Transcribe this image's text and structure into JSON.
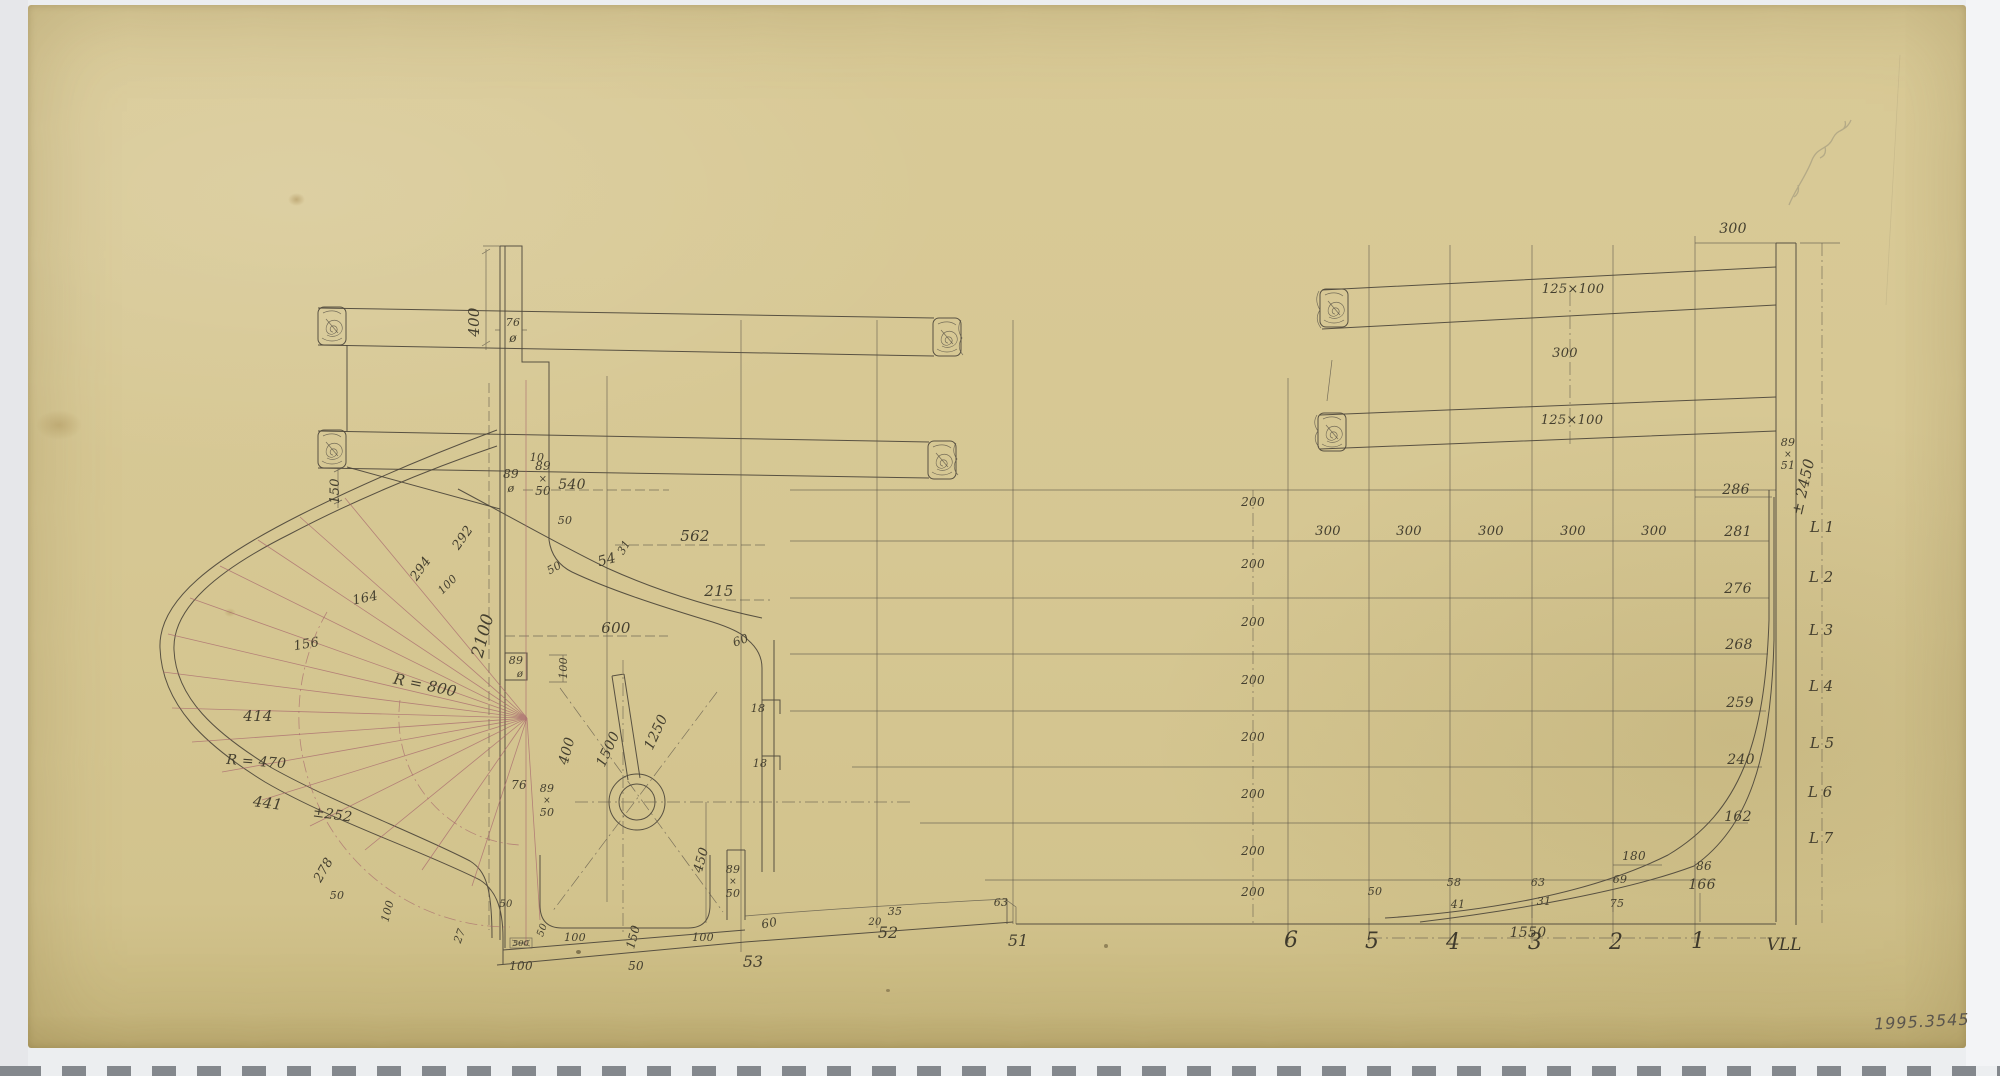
{
  "artifact": {
    "accession_number": "1995.3545",
    "pencil_note": "illegible pencil inscription (top right)"
  },
  "palette": {
    "paper": "#d6c793",
    "ink": "#4d463b",
    "red_construction_lines": "#a5636c",
    "film_strip_mark": "#84888d",
    "scan_background": "#eceef0"
  },
  "views": {
    "stern_detail": {
      "labels": [
        [
          "400",
          479,
          322,
          -90,
          15,
          "dim"
        ],
        [
          "76",
          513,
          326,
          0,
          11,
          "dim"
        ],
        [
          "ø",
          513,
          342,
          0,
          12,
          "dim"
        ],
        [
          "150",
          339,
          491,
          -90,
          13,
          "dim"
        ],
        [
          "10",
          537,
          461,
          0,
          11,
          "dim"
        ],
        [
          "89",
          511,
          478,
          0,
          12,
          "dim"
        ],
        [
          "ø",
          511,
          492,
          0,
          11,
          "dim"
        ],
        [
          "89",
          543,
          470,
          0,
          12,
          "dim"
        ],
        [
          "×",
          543,
          482,
          0,
          10,
          "dim"
        ],
        [
          "50",
          543,
          495,
          0,
          12,
          "dim"
        ],
        [
          "540",
          572,
          489,
          0,
          14,
          "dim"
        ],
        [
          "50",
          565,
          524,
          0,
          11,
          "dim"
        ],
        [
          "50",
          556,
          571,
          -30,
          11,
          "dim"
        ],
        [
          "562",
          695,
          541,
          0,
          15,
          "dim"
        ],
        [
          "54",
          608,
          564,
          -15,
          14,
          "dim"
        ],
        [
          "31",
          627,
          549,
          -60,
          11,
          "dim"
        ],
        [
          "215",
          719,
          596,
          0,
          15,
          "dim"
        ],
        [
          "600",
          616,
          633,
          0,
          15,
          "dim"
        ],
        [
          "60",
          742,
          644,
          -20,
          12,
          "dim"
        ],
        [
          "18",
          758,
          712,
          0,
          11,
          "dim"
        ],
        [
          "18",
          760,
          767,
          0,
          11,
          "dim"
        ],
        [
          "292",
          466,
          540,
          -55,
          13,
          "dim"
        ],
        [
          "294",
          424,
          571,
          -55,
          13,
          "dim"
        ],
        [
          "100",
          450,
          587,
          -45,
          11,
          "dim"
        ],
        [
          "164",
          366,
          602,
          -12,
          13,
          "dim"
        ],
        [
          "156",
          307,
          648,
          -10,
          13,
          "dim"
        ],
        [
          "R = 800",
          424,
          690,
          12,
          15,
          "dim"
        ],
        [
          "414",
          258,
          721,
          0,
          15,
          "dim"
        ],
        [
          "R = 470",
          256,
          766,
          4,
          14,
          "dim"
        ],
        [
          "441",
          267,
          808,
          8,
          15,
          "dim"
        ],
        [
          "±252",
          332,
          819,
          8,
          14,
          "dim"
        ],
        [
          "278",
          327,
          872,
          -60,
          13,
          "dim"
        ],
        [
          "50",
          337,
          899,
          0,
          11,
          "dim"
        ],
        [
          "100",
          391,
          912,
          -75,
          11,
          "dim"
        ],
        [
          "2100",
          488,
          637,
          -75,
          17,
          "dim"
        ],
        [
          "89",
          516,
          664,
          0,
          11,
          "dim"
        ],
        [
          "ø",
          520,
          677,
          0,
          10,
          "dim"
        ],
        [
          "100",
          567,
          668,
          -90,
          11,
          "dim"
        ],
        [
          "400",
          571,
          752,
          -75,
          14,
          "dim"
        ],
        [
          "1500",
          612,
          751,
          -65,
          14,
          "dim"
        ],
        [
          "1250",
          660,
          734,
          -65,
          14,
          "dim"
        ],
        [
          "76",
          519,
          789,
          0,
          12,
          "dim"
        ],
        [
          "89",
          547,
          792,
          0,
          11,
          "dim"
        ],
        [
          "×",
          547,
          803,
          0,
          9,
          "dim"
        ],
        [
          "50",
          547,
          816,
          0,
          11,
          "dim"
        ],
        [
          "27",
          463,
          937,
          -70,
          11,
          "dim"
        ],
        [
          "50",
          506,
          907,
          0,
          10,
          "dim"
        ],
        [
          "500",
          521,
          946,
          0,
          8,
          "dim"
        ],
        [
          "50",
          545,
          931,
          -70,
          10,
          "dim"
        ],
        [
          "100",
          575,
          941,
          0,
          11,
          "dim"
        ],
        [
          "150",
          637,
          938,
          -75,
          12,
          "dim"
        ],
        [
          "100",
          703,
          941,
          0,
          11,
          "dim"
        ],
        [
          "450",
          705,
          861,
          -75,
          13,
          "dim"
        ],
        [
          "89",
          733,
          873,
          0,
          11,
          "dim"
        ],
        [
          "×",
          733,
          884,
          0,
          9,
          "dim"
        ],
        [
          "50",
          733,
          897,
          0,
          11,
          "dim"
        ],
        [
          "60",
          770,
          927,
          -10,
          12,
          "dim"
        ],
        [
          "53",
          753,
          967,
          0,
          16,
          "sta2"
        ],
        [
          "50",
          636,
          970,
          0,
          12,
          "dim"
        ],
        [
          "100",
          521,
          970,
          0,
          12,
          "dim"
        ],
        [
          "35",
          895,
          915,
          0,
          11,
          "dim"
        ],
        [
          "20",
          875,
          925,
          0,
          10,
          "dim"
        ],
        [
          "52",
          888,
          938,
          0,
          16,
          "sta2"
        ],
        [
          "63",
          1001,
          906,
          0,
          11,
          "dim"
        ],
        [
          "51",
          1018,
          946,
          0,
          16,
          "sta2"
        ]
      ]
    },
    "bow_grid": {
      "labels": [
        [
          "200",
          1253,
          506,
          0,
          12,
          "dim"
        ],
        [
          "200",
          1253,
          568,
          0,
          12,
          "dim"
        ],
        [
          "200",
          1253,
          626,
          0,
          12,
          "dim"
        ],
        [
          "200",
          1253,
          684,
          0,
          12,
          "dim"
        ],
        [
          "200",
          1253,
          741,
          0,
          12,
          "dim"
        ],
        [
          "200",
          1253,
          798,
          0,
          12,
          "dim"
        ],
        [
          "200",
          1253,
          855,
          0,
          12,
          "dim"
        ],
        [
          "200",
          1253,
          896,
          0,
          12,
          "dim"
        ],
        [
          "300",
          1328,
          535,
          0,
          13,
          "dim"
        ],
        [
          "300",
          1409,
          535,
          0,
          13,
          "dim"
        ],
        [
          "300",
          1491,
          535,
          0,
          13,
          "dim"
        ],
        [
          "300",
          1573,
          535,
          0,
          13,
          "dim"
        ],
        [
          "300",
          1654,
          535,
          0,
          13,
          "dim"
        ],
        [
          "286",
          1736,
          494,
          0,
          14,
          "dim"
        ],
        [
          "281",
          1738,
          536,
          0,
          14,
          "dim"
        ],
        [
          "276",
          1738,
          593,
          0,
          14,
          "dim"
        ],
        [
          "268",
          1739,
          649,
          0,
          14,
          "dim"
        ],
        [
          "259",
          1740,
          707,
          0,
          14,
          "dim"
        ],
        [
          "240",
          1741,
          764,
          0,
          14,
          "dim"
        ],
        [
          "162",
          1738,
          821,
          0,
          14,
          "dim"
        ],
        [
          "86",
          1704,
          870,
          0,
          12,
          "dim"
        ],
        [
          "180",
          1634,
          860,
          0,
          12,
          "dim"
        ],
        [
          "69",
          1620,
          883,
          0,
          11,
          "dim"
        ],
        [
          "75",
          1617,
          907,
          0,
          11,
          "dim"
        ],
        [
          "63",
          1538,
          886,
          0,
          11,
          "dim"
        ],
        [
          "31",
          1544,
          905,
          0,
          11,
          "dim"
        ],
        [
          "58",
          1454,
          886,
          0,
          11,
          "dim"
        ],
        [
          "41",
          1458,
          908,
          0,
          11,
          "dim"
        ],
        [
          "50",
          1375,
          895,
          0,
          11,
          "dim"
        ],
        [
          "166",
          1702,
          889,
          0,
          14,
          "dim"
        ],
        [
          "1550",
          1528,
          937,
          0,
          14,
          "dim"
        ],
        [
          "6",
          1291,
          947,
          0,
          22,
          "sta"
        ],
        [
          "5",
          1372,
          948,
          0,
          22,
          "sta"
        ],
        [
          "4",
          1453,
          949,
          0,
          22,
          "sta"
        ],
        [
          "3",
          1535,
          949,
          0,
          22,
          "sta"
        ],
        [
          "2",
          1616,
          949,
          0,
          22,
          "sta"
        ],
        [
          "1",
          1698,
          948,
          0,
          22,
          "sta"
        ],
        [
          "VLL",
          1784,
          950,
          0,
          17,
          "sta"
        ],
        [
          "125×100",
          1573,
          293,
          0,
          13,
          "dim"
        ],
        [
          "300",
          1565,
          357,
          0,
          13,
          "dim"
        ],
        [
          "125×100",
          1572,
          424,
          0,
          13,
          "dim"
        ],
        [
          "300",
          1733,
          233,
          0,
          14,
          "dim"
        ],
        [
          "89",
          1788,
          446,
          0,
          11,
          "dim"
        ],
        [
          "×",
          1788,
          457,
          0,
          9,
          "dim"
        ],
        [
          "51",
          1788,
          469,
          0,
          11,
          "dim"
        ],
        [
          "± 2450",
          1808,
          488,
          -77,
          15,
          "dim"
        ],
        [
          "L 1",
          1822,
          532,
          0,
          15,
          "sta2"
        ],
        [
          "L 2",
          1821,
          582,
          0,
          15,
          "sta2"
        ],
        [
          "L 3",
          1821,
          635,
          0,
          15,
          "sta2"
        ],
        [
          "L 4",
          1821,
          691,
          0,
          15,
          "sta2"
        ],
        [
          "L 5",
          1822,
          748,
          0,
          15,
          "sta2"
        ],
        [
          "L 6",
          1820,
          797,
          0,
          15,
          "sta2"
        ],
        [
          "L 7",
          1821,
          843,
          0,
          15,
          "sta2"
        ]
      ]
    }
  }
}
